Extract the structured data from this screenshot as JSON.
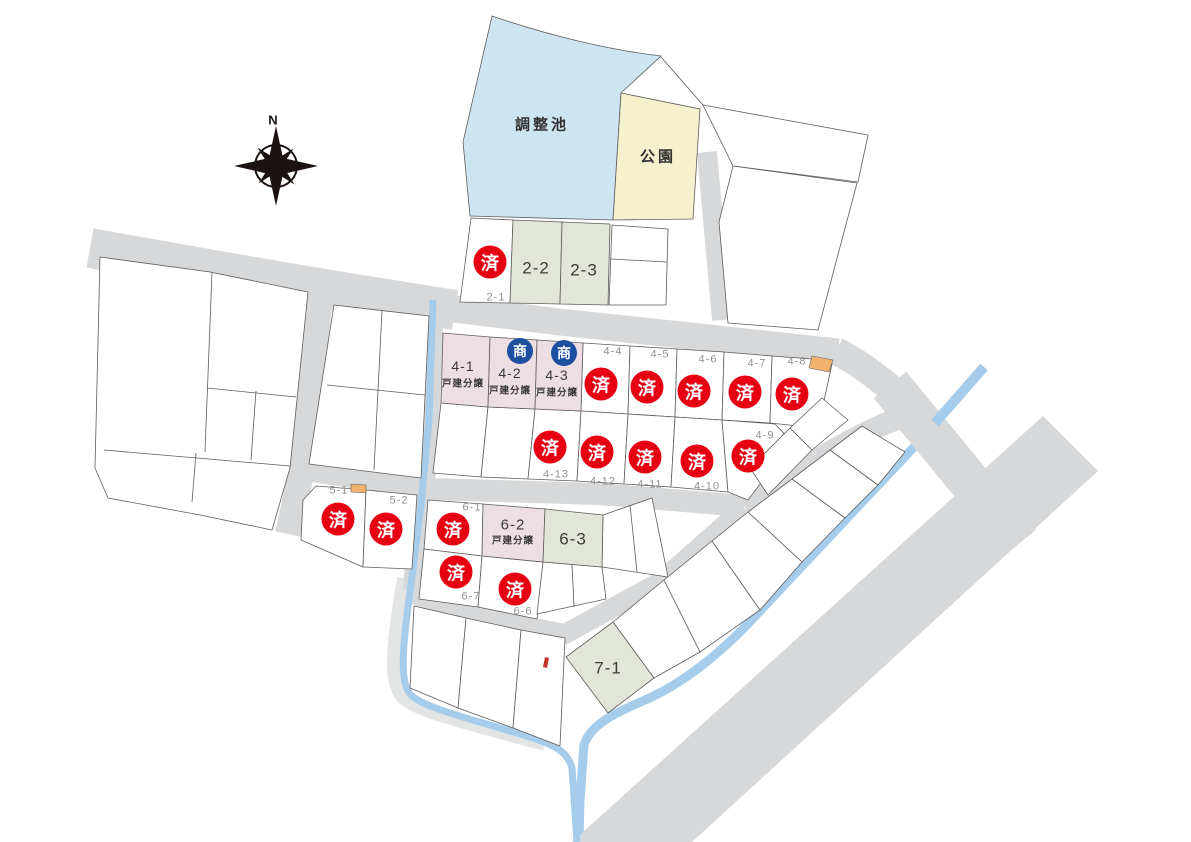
{
  "map_title": "分譲区画図",
  "compass": {
    "label": "N"
  },
  "areas": {
    "pond": "調整池",
    "park": "公園"
  },
  "markers": {
    "sold": "済",
    "commercial": "商"
  },
  "colors": {
    "sold_red": "#e60012",
    "commercial_blue": "#1e50a2",
    "pond_blue": "#cde4f1",
    "park_yellow": "#f6f1cd",
    "residential_pink": "#eddee3",
    "available_green": "#e2e6da",
    "road_gray": "#d7d8d9",
    "stream_blue": "#a5cdeb",
    "accent_orange": "#f3b26d"
  },
  "lots": {
    "l2_1": {
      "label": "2-1",
      "status": "sold"
    },
    "l2_2": {
      "label": "2-2",
      "status": "available"
    },
    "l2_3": {
      "label": "2-3",
      "status": "available"
    },
    "l4_1": {
      "label": "4-1",
      "sublabel": "戸建分譲",
      "status": "available"
    },
    "l4_2": {
      "label": "4-2",
      "sublabel": "戸建分譲",
      "status": "commercial"
    },
    "l4_3": {
      "label": "4-3",
      "sublabel": "戸建分譲",
      "status": "commercial"
    },
    "l4_4": {
      "label": "4-4",
      "status": "sold"
    },
    "l4_5": {
      "label": "4-5",
      "status": "sold"
    },
    "l4_6": {
      "label": "4-6",
      "status": "sold"
    },
    "l4_7": {
      "label": "4-7",
      "status": "sold"
    },
    "l4_8": {
      "label": "4-8",
      "status": "sold"
    },
    "l4_9": {
      "label": "4-9",
      "status": "sold"
    },
    "l4_10": {
      "label": "4-10",
      "status": "sold"
    },
    "l4_11": {
      "label": "4-11",
      "status": "sold"
    },
    "l4_12": {
      "label": "4-12",
      "status": "sold"
    },
    "l4_13": {
      "label": "4-13",
      "status": "sold"
    },
    "l5_1": {
      "label": "5-1",
      "status": "sold"
    },
    "l5_2": {
      "label": "5-2",
      "status": "sold"
    },
    "l6_1": {
      "label": "6-1",
      "status": "sold"
    },
    "l6_2": {
      "label": "6-2",
      "sublabel": "戸建分譲",
      "status": "available"
    },
    "l6_3": {
      "label": "6-3",
      "status": "available"
    },
    "l6_6": {
      "label": "6-6",
      "status": "sold"
    },
    "l6_7": {
      "label": "6-7",
      "status": "sold"
    },
    "l7_1": {
      "label": "7-1",
      "status": "available"
    }
  }
}
